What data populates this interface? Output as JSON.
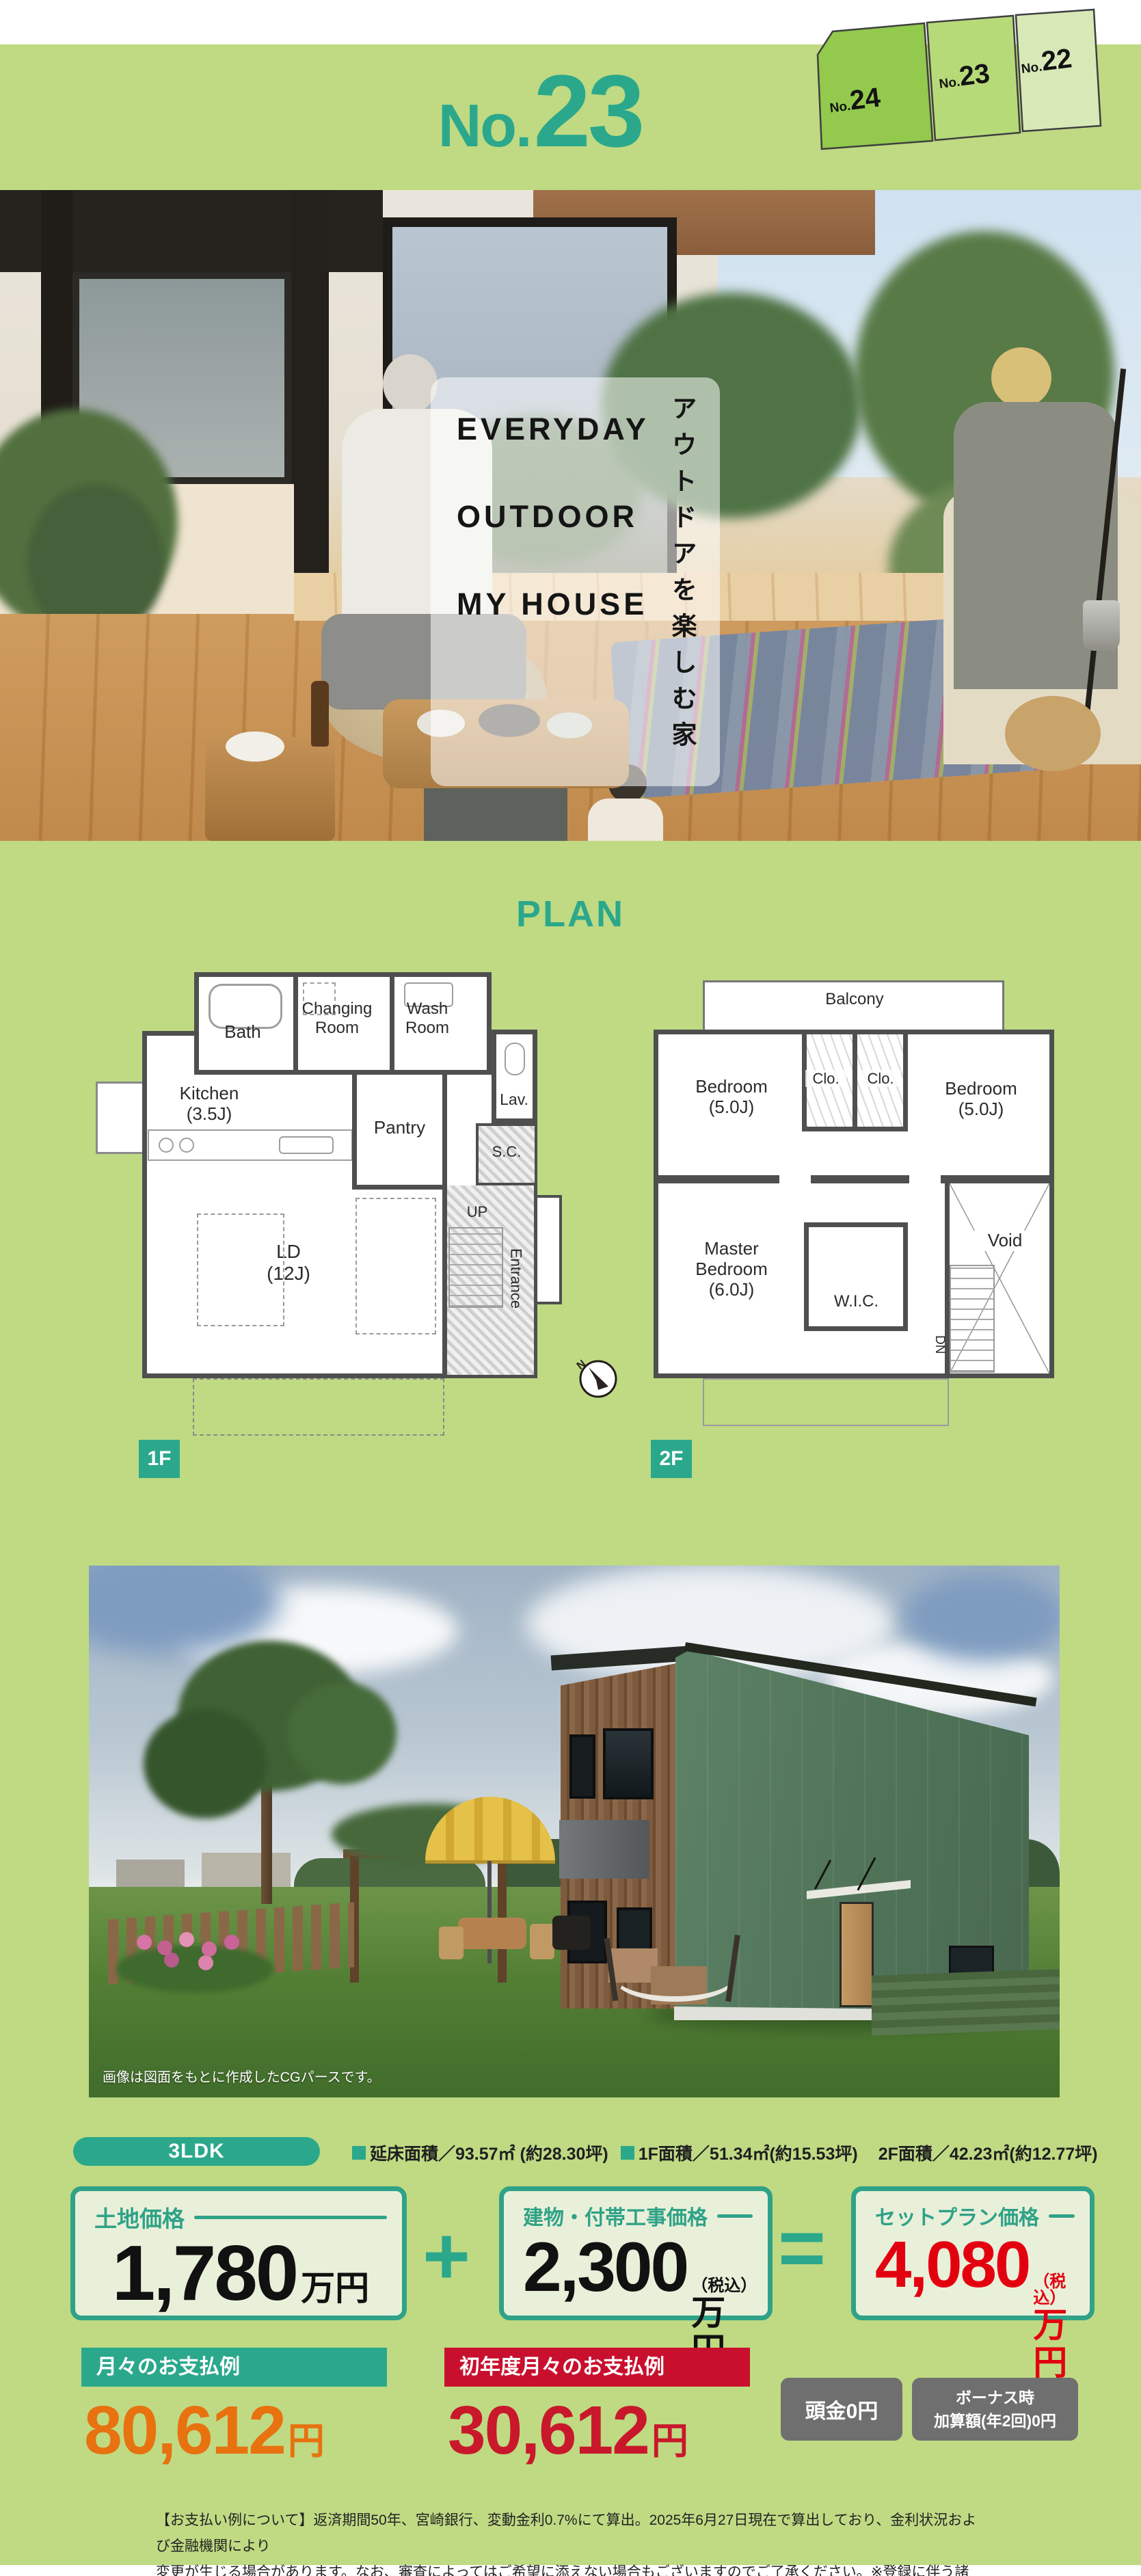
{
  "header": {
    "plot_prefix": "No.",
    "plot_number": "23",
    "lots": [
      {
        "prefix": "No.",
        "number": "24"
      },
      {
        "prefix": "No.",
        "number": "23"
      },
      {
        "prefix": "No.",
        "number": "22"
      }
    ]
  },
  "hero": {
    "title_line1": "EVERYDAY",
    "title_line2": "OUTDOOR",
    "title_line3": "MY HOUSE",
    "vertical_tagline": "アウトドアを楽しむ家"
  },
  "plan": {
    "title": "PLAN",
    "compass": "N",
    "f1": {
      "badge": "1F",
      "bath": "Bath",
      "changing": "Changing Room",
      "wash": "Wash Room",
      "kitchen": "Kitchen (3.5J)",
      "pantry": "Pantry",
      "lav": "Lav.",
      "sc": "S.C.",
      "up": "UP",
      "entrance": "Entrance",
      "ld": "LD (12J)"
    },
    "f2": {
      "badge": "2F",
      "balcony": "Balcony",
      "bedroom_left": "Bedroom (5.0J)",
      "bedroom_right": "Bedroom (5.0J)",
      "clo_left": "Clo.",
      "clo_right": "Clo.",
      "master": "Master Bedroom (6.0J)",
      "wic": "W.I.C.",
      "void": "Void",
      "dn": "DN"
    }
  },
  "render": {
    "caption": "画像は図面をもとに作成したCGパースです。"
  },
  "summary": {
    "layout": "3LDK",
    "area_total": "延床面積／93.57㎡ (約28.30坪)",
    "area_1f": "1F面積／51.34㎡(約15.53坪)",
    "area_2f": "2F面積／42.23㎡(約12.77坪)"
  },
  "pricing": {
    "land_label": "土地価格",
    "land_value": "1,780",
    "land_unit": "万円",
    "plus": "+",
    "building_label": "建物・付帯工事価格",
    "building_value": "2,300",
    "building_tax": "（税込）",
    "building_unit": "万円",
    "equals": "=",
    "set_label": "セットプラン価格",
    "set_value": "4,080",
    "set_tax": "（税込）",
    "set_unit": "万円"
  },
  "payment": {
    "monthly_label": "月々のお支払例",
    "monthly_value": "80,612",
    "monthly_unit": "円",
    "first_label": "初年度月々のお支払例",
    "first_value": "30,612",
    "first_unit": "円",
    "down": "頭金0円",
    "bonus_line1": "ボーナス時",
    "bonus_line2": "加算額(年2回)0円"
  },
  "footer": {
    "line1": "【お支払い例について】返済期間50年、宮崎銀行、変動金利0.7%にて算出。2025年6月27日現在で算出しており、金利状況および金融機関により",
    "line2": "変更が生じる場合があります。なお、審査によってはご希望に添えない場合もございますのでご了承ください。※登録に伴う諸費用が別途必要です。"
  }
}
